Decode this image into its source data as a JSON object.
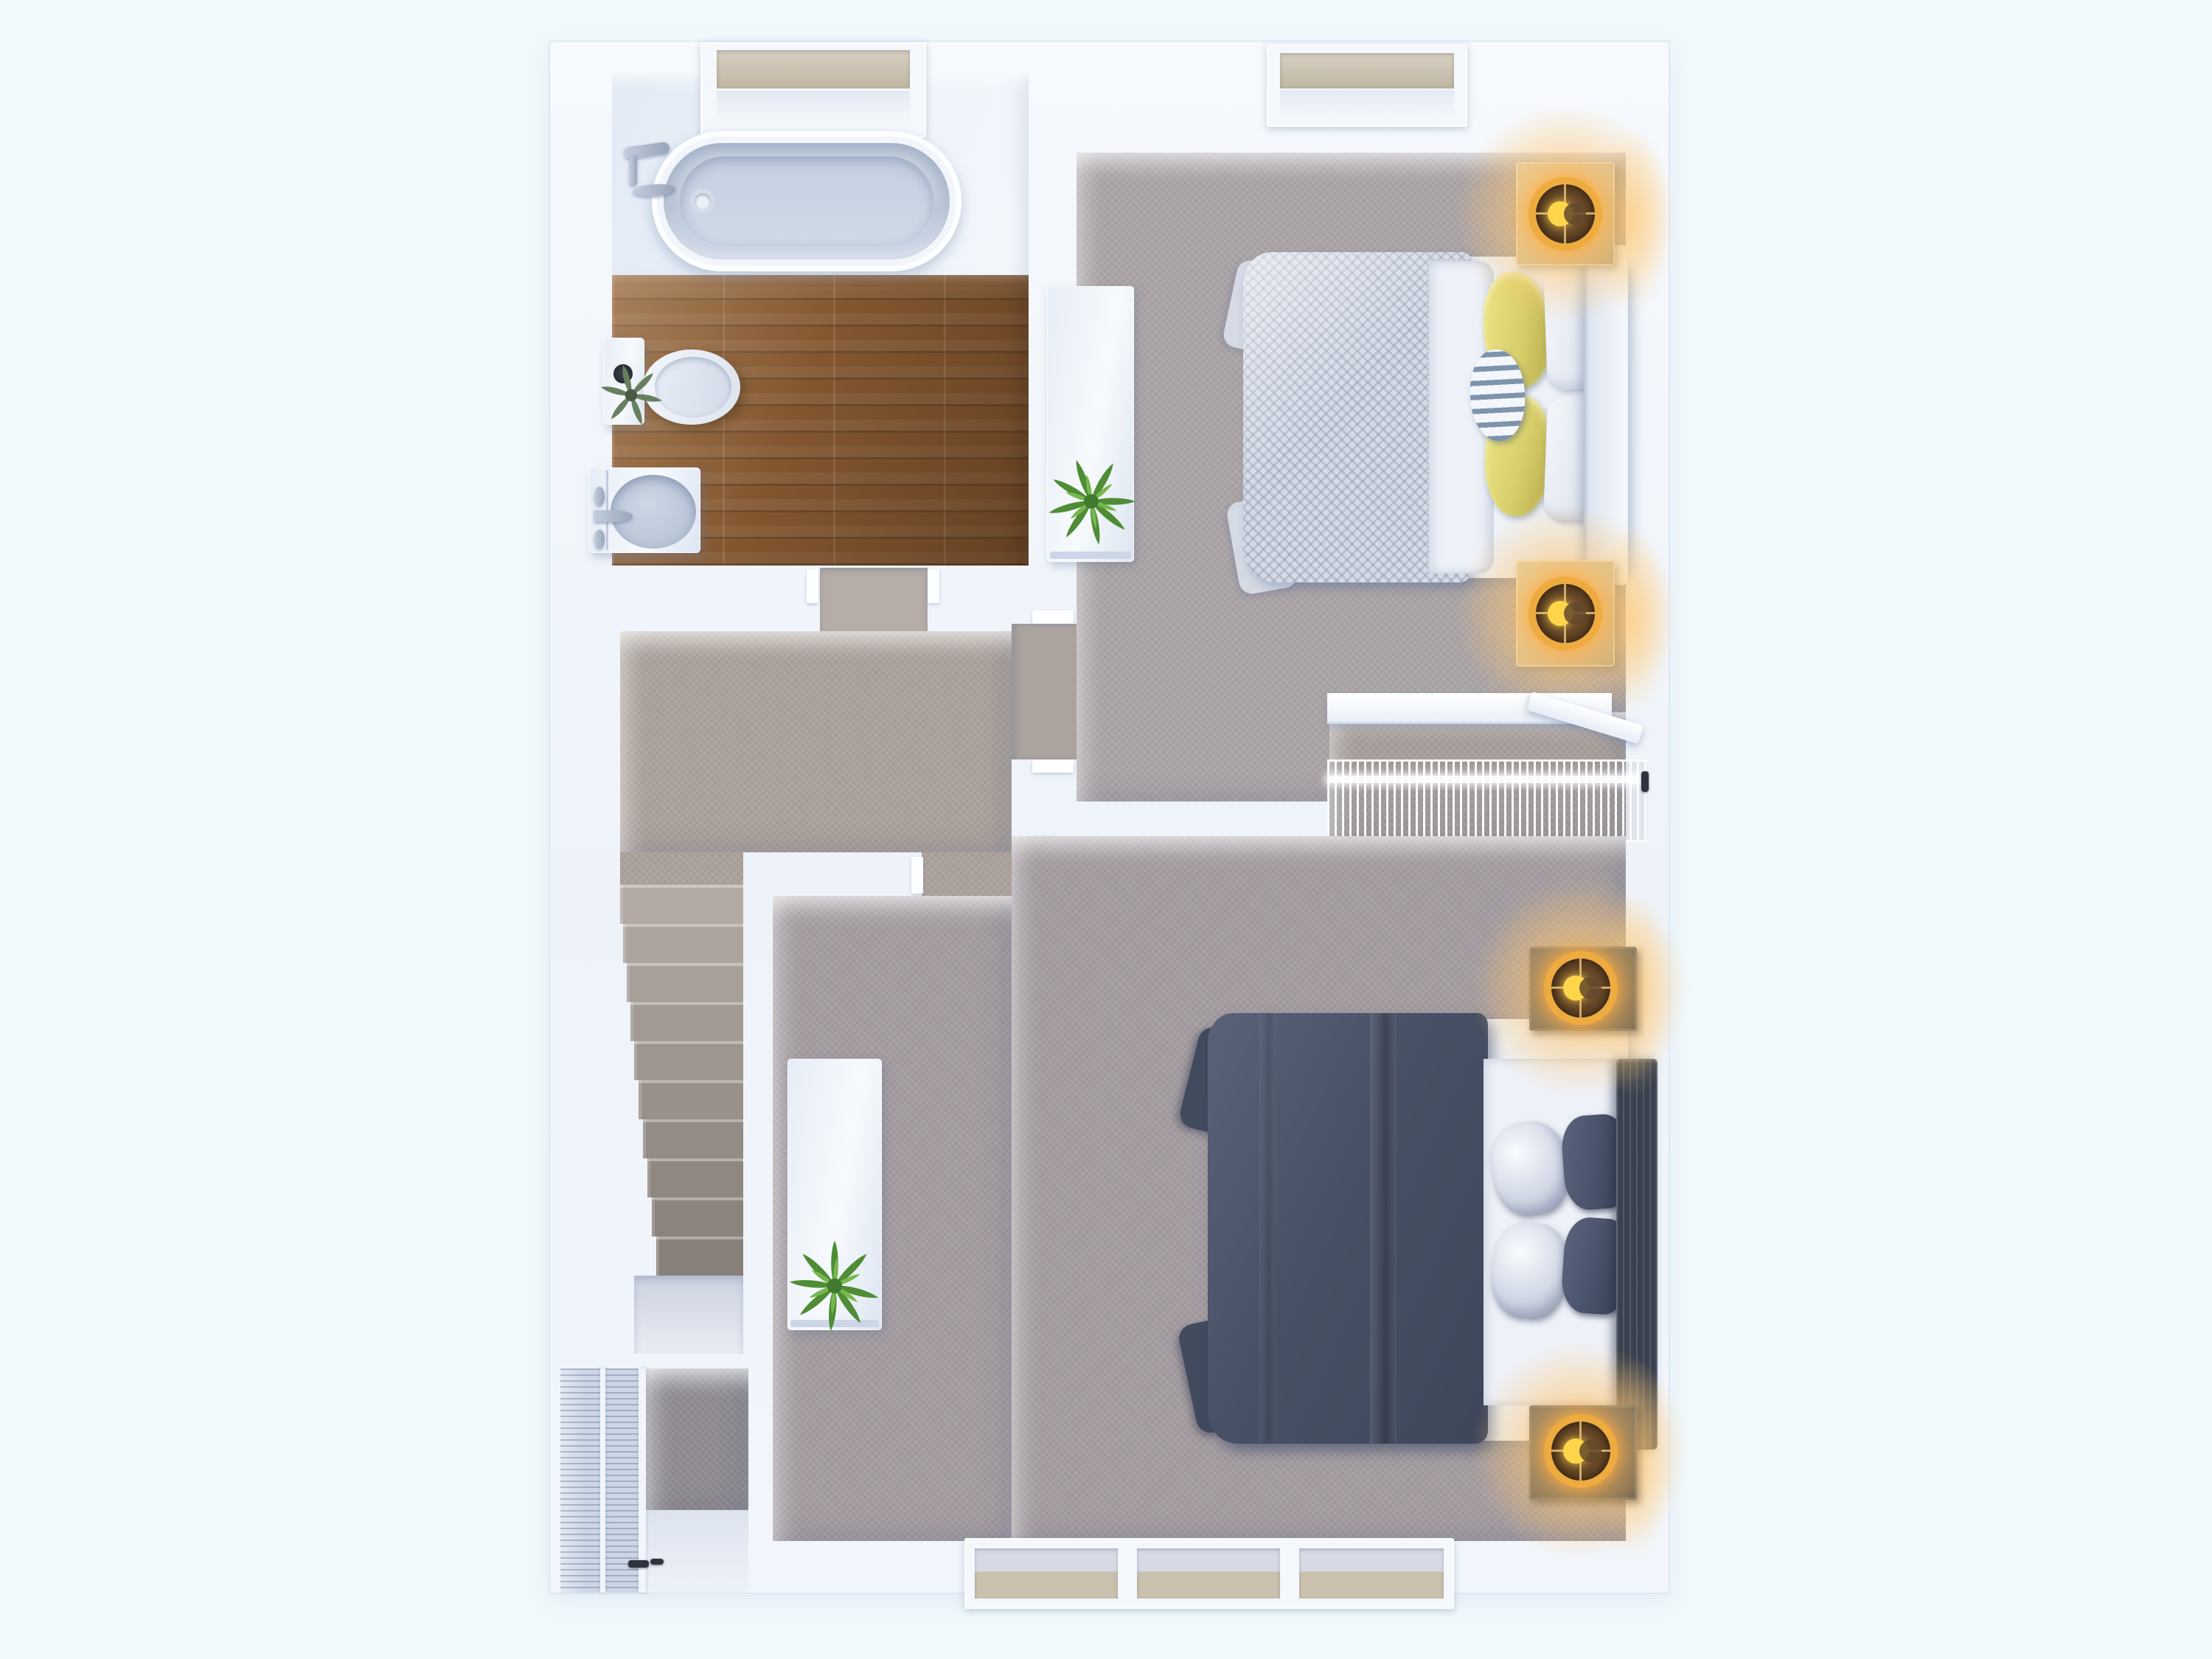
{
  "scene": {
    "type": "3d-floor-plan-top-view",
    "description": "Rendered top-down dollhouse view of an upper floor with a bathroom, hallway staircase, two bedrooms and closets. No text labels are visible in the image.",
    "visible_text": ""
  },
  "colors": {
    "bg": "#f1f9fc",
    "wall": "#f3f6fc",
    "platform": "#e2eaf5",
    "wood": "#83562f",
    "carpet_hall": "#aba19b",
    "carpet_bed1": "#aba4a6",
    "carpet_bed2": "#a49ca0",
    "carpet_closet": "#a79e9a",
    "carpet_dark": "#8f8b91",
    "duvet_light": "#d5dae5",
    "sheet_white": "#eef1f8",
    "pillow_yellow": "#d8cf6a",
    "pillow_yellow_dark": "#b3a84b",
    "accent_blue": "#7e93ac",
    "duvet_dark": "#475064",
    "duvet_dark2": "#424a5e",
    "pillow_dark": "#49526a",
    "headboard_dark": "#39404e",
    "nightstand_light": "#cfbd98",
    "nightstand_dark": "#3d434e",
    "lamp_gold": "#eeab3f",
    "crescent": "#ffd64a",
    "glass_tan": "#c9c0ae",
    "glass_gray": "#d5dae4",
    "plant_green": "#5a9b3f",
    "plant_green_dark": "#3f7a2e"
  },
  "rooms": [
    {
      "name": "bathroom",
      "furniture": [
        "skylight-window",
        "bathtub",
        "bath-faucet",
        "toilet",
        "toilet-plant",
        "vanity-sink",
        "wood-floor"
      ]
    },
    {
      "name": "hallway",
      "furniture": [
        "staircase-down",
        "stair-landing"
      ]
    },
    {
      "name": "bedroom-top",
      "furniture": [
        "window",
        "double-bed-white",
        "yellow-pillows",
        "accent-pillow",
        "nightstand-x2",
        "table-lamp-x2",
        "dresser",
        "potted-plant"
      ]
    },
    {
      "name": "walk-in-closet",
      "furniture": [
        "shelf",
        "closet-rod",
        "wire-shelf-rack",
        "open-door"
      ]
    },
    {
      "name": "bedroom-bottom",
      "furniture": [
        "triple-window",
        "double-bed-dark",
        "white-pillows",
        "dark-pillows",
        "nightstand-x2",
        "table-lamp-x2",
        "dresser",
        "potted-plant",
        "louvered-closet"
      ]
    }
  ]
}
